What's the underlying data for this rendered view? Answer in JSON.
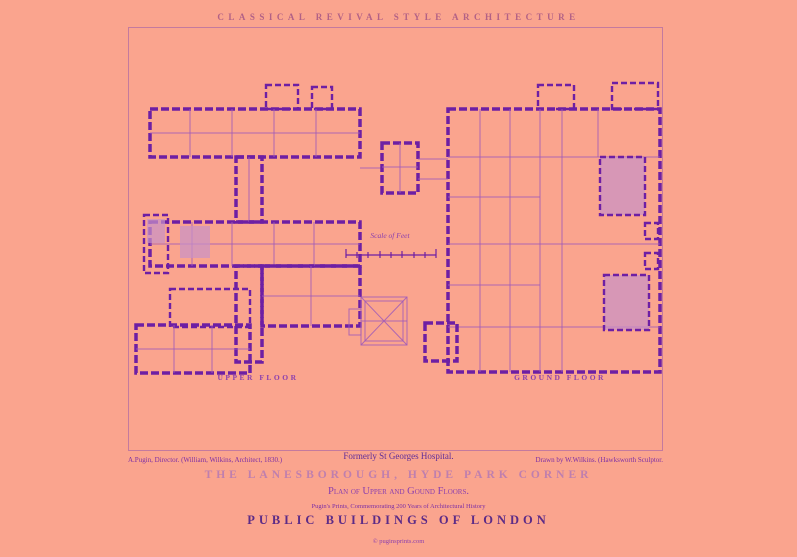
{
  "colors": {
    "background": "#faa48e",
    "frame": "#c47a9e",
    "ink": "#6d1fa4",
    "ink_light": "#a05cb8",
    "wash": "#c791c8",
    "title": "#b26186",
    "caption": "#7d2fa5",
    "subtitle": "#8b3fae",
    "dark_title": "#5c2b87",
    "light_title": "#bf7fae",
    "formerly": "#5f2d9a"
  },
  "header": {
    "series_heading": "CLASSICAL REVIVAL STYLE ARCHITECTURE"
  },
  "plate": {
    "upper_floor_label": "UPPER FLOOR",
    "ground_floor_label": "GROUND FLOOR",
    "scale_caption": "Scale of Feet"
  },
  "credits": {
    "left": "A.Pugin, Director. (William, Wilkins, Architect, 1830.)",
    "center": "Formerly St Georges Hospital.",
    "right": "Drawn by W.Wilkins. (Hawksworth Sculptor."
  },
  "titles": {
    "main": "THE LANESBOROUGH, HYDE PARK CORNER",
    "subtitle": "Plan of Upper and Gound Floors.",
    "series_note": "Pugin's Prints, Commemorating 200 Years of Architectural History",
    "series": "PUBLIC BUILDINGS OF LONDON",
    "copyright": "© puginsprints.com"
  }
}
